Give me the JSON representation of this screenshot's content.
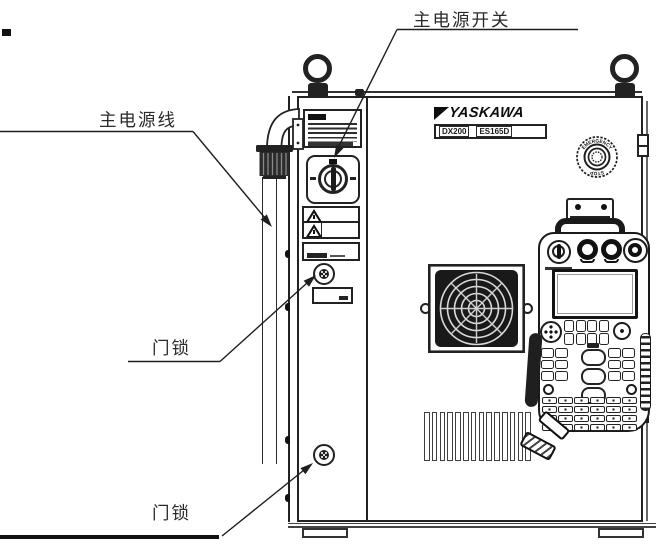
{
  "figure": {
    "bg_color": "#ffffff",
    "ink_color": "#1f1f1f"
  },
  "callouts": {
    "main_power_switch": "主电源开关",
    "main_power_cable": "主电源线",
    "door_lock_upper": "门锁",
    "door_lock_lower": "门锁"
  },
  "cabinet": {
    "brand": "YASKAWA",
    "model_primary": "DX200",
    "model_secondary": "ES165D",
    "estop_text_top": "EMERGENCY",
    "estop_text_bottom": "STOP",
    "vent_slat_count": 14
  },
  "pendant": {
    "top_key_count": 8,
    "left_key_count": 6,
    "right_key_count": 6,
    "center_key_count": 3,
    "bottom_key_count": 24
  }
}
